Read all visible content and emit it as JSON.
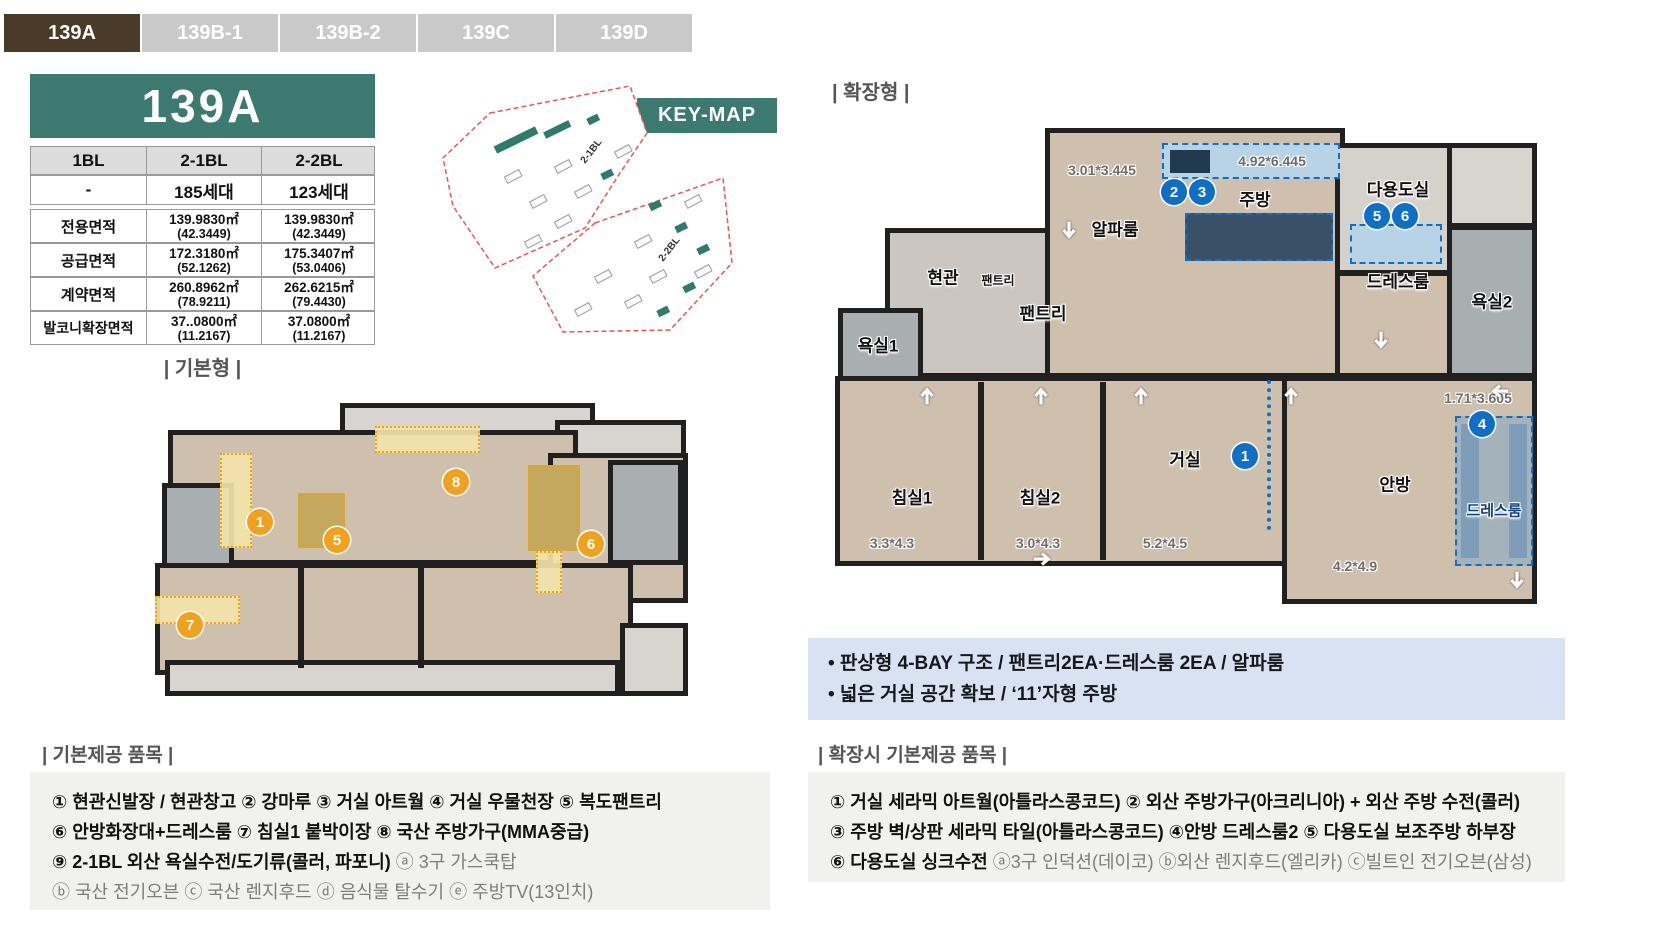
{
  "tabs": [
    {
      "label": "139A",
      "active": true
    },
    {
      "label": "139B-1",
      "active": false
    },
    {
      "label": "139B-2",
      "active": false
    },
    {
      "label": "139C",
      "active": false
    },
    {
      "label": "139D",
      "active": false
    }
  ],
  "unit_table": {
    "title": "139A",
    "col_headers": [
      "1BL",
      "2-1BL",
      "2-2BL"
    ],
    "household_row": [
      "-",
      "185세대",
      "123세대"
    ],
    "rows": [
      {
        "label": "전용면적",
        "c1": "139.9830㎡",
        "c1_sub": "(42.3449)",
        "c2": "139.9830㎡",
        "c2_sub": "(42.3449)"
      },
      {
        "label": "공급면적",
        "c1": "172.3180㎡",
        "c1_sub": "(52.1262)",
        "c2": "175.3407㎡",
        "c2_sub": "(53.0406)"
      },
      {
        "label": "계약면적",
        "c1": "260.8962㎡",
        "c1_sub": "(78.9211)",
        "c2": "262.6215㎡",
        "c2_sub": "(79.4430)"
      },
      {
        "label": "발코니확장면적",
        "c1": "37..0800㎡",
        "c1_sub": "(11.2167)",
        "c2": "37.0800㎡",
        "c2_sub": "(11.2167)"
      }
    ]
  },
  "key_map": {
    "badge": "KEY-MAP",
    "block_labels": [
      "2-1BL",
      "2-2BL"
    ]
  },
  "basic_plan": {
    "heading": "| 기본형 |",
    "badges": [
      "1",
      "5",
      "6",
      "7",
      "8"
    ]
  },
  "extended_plan": {
    "heading": "| 확장형 |",
    "badges": [
      "1",
      "2",
      "3",
      "4",
      "5",
      "6"
    ],
    "rooms": {
      "alpha": {
        "name": "알파룸",
        "dim": "3.01*3.445"
      },
      "kitchen": {
        "name": "주방",
        "dim": "4.92*6.445"
      },
      "utility": {
        "name": "다용도실"
      },
      "dress1": {
        "name": "드레스룸"
      },
      "bath2": {
        "name": "욕실2"
      },
      "entry": {
        "name": "현관"
      },
      "pantry_small": {
        "name": "팬트리"
      },
      "pantry": {
        "name": "팬트리"
      },
      "bath1": {
        "name": "욕실1"
      },
      "bed1": {
        "name": "침실1",
        "dim": "3.3*4.3"
      },
      "bed2": {
        "name": "침실2",
        "dim": "3.0*4.3"
      },
      "living": {
        "name": "거실",
        "dim": "5.2*4.5"
      },
      "master": {
        "name": "안방",
        "dim": "4.2*4.9"
      },
      "dress2": {
        "name": "드레스룸",
        "dim": "1.71*3.605"
      }
    }
  },
  "summary_box": {
    "bullets": [
      "• 판상형 4-BAY 구조 / 팬트리2EA·드레스룸 2EA / 알파룸",
      "• 넓은 거실 공간 확보 / ‘11’자형 주방"
    ]
  },
  "basic_items": {
    "heading": "| 기본제공 품목 |",
    "line1": "① 현관신발장 / 현관창고 ② 강마루 ③ 거실 아트월  ④ 거실 우물천장 ⑤ 복도팬트리",
    "line2": "⑥ 안방화장대+드레스룸 ⑦ 침실1 붙박이장 ⑧ 국산 주방가구(MMA중급)",
    "line3_bold": "⑨ 2-1BL 외산 욕실수전/도기류(콜러, 파포니) ",
    "line3_gray": "ⓐ 3구 가스쿡탑",
    "line4": "ⓑ 국산 전기오븐 ⓒ 국산 렌지후드 ⓓ 음식물 탈수기 ⓔ 주방TV(13인치)"
  },
  "extended_items": {
    "heading": "| 확장시 기본제공 품목 |",
    "line1": "① 거실 세라믹 아트월(아틀라스콩코드) ② 외산 주방가구(아크리니아) + 외산 주방 수전(콜러)",
    "line2": "③ 주방 벽/상판 세라믹 타일(아틀라스콩코드) ④안방 드레스룸2 ⑤ 다용도실 보조주방 하부장",
    "line3_bold": "⑥ 다용도실 싱크수전 ",
    "line3_gray": "ⓐ3구 인덕션(데이코) ⓑ외산 렌지후드(엘리카)   ⓒ빌트인 전기오븐(삼성)"
  },
  "colors": {
    "accent_teal": "#3c7a71",
    "tab_active_brown": "#4a3b28",
    "badge_orange": "#f0a11e",
    "badge_blue": "#0f6fc5",
    "highlight_yellow": "#f3e3a9",
    "highlight_blue": "#b9d3e6",
    "summary_bg": "#d9e2f3",
    "items_bg": "#f1f1ef"
  }
}
